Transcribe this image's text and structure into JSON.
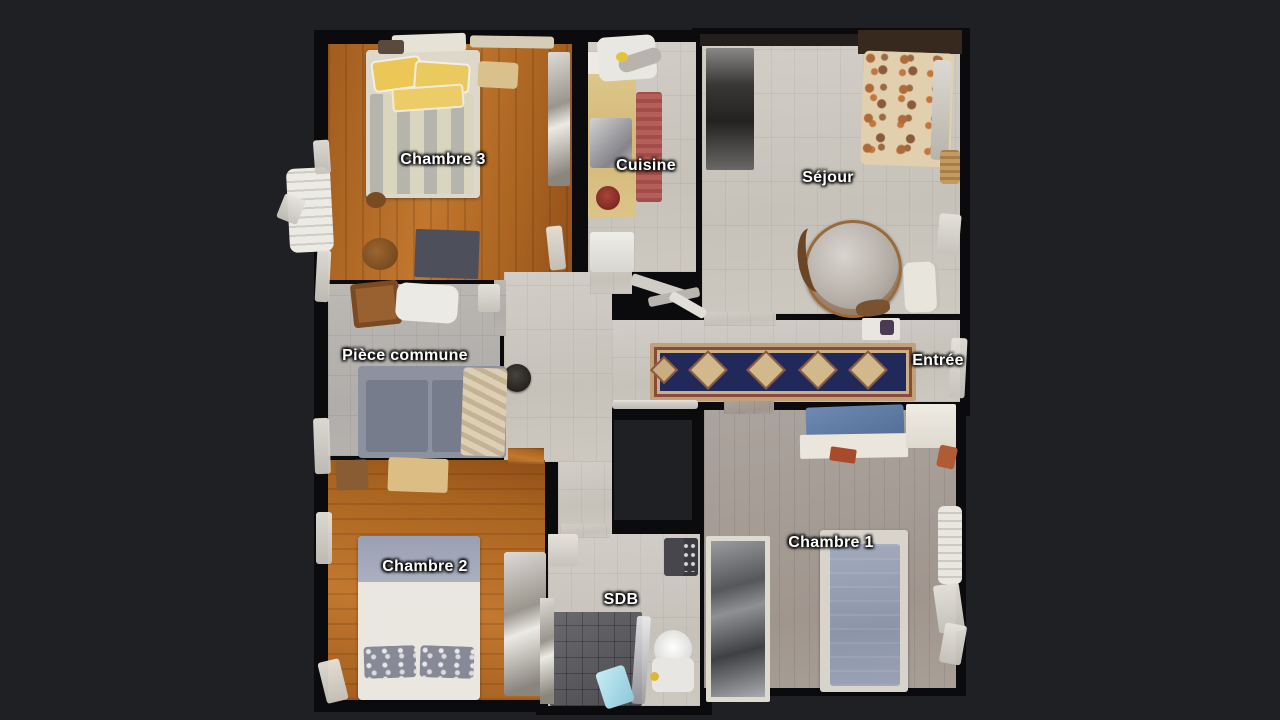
{
  "viewer": {
    "type": "3D dollhouse floor plan, top-down view",
    "background": "#1f2023"
  },
  "floorplan": {
    "rooms": [
      {
        "name": "Chambre 3",
        "floor": "hardwood"
      },
      {
        "name": "Cuisine",
        "floor": "tile"
      },
      {
        "name": "Séjour",
        "floor": "tile"
      },
      {
        "name": "Pièce commune",
        "floor": "tile"
      },
      {
        "name": "Entrée",
        "floor": "tile"
      },
      {
        "name": "Chambre 2",
        "floor": "hardwood"
      },
      {
        "name": "SDB",
        "floor": "tile"
      },
      {
        "name": "Chambre 1",
        "floor": "laminate"
      }
    ],
    "label_style": {
      "text_color": "#ffffff",
      "outline_color": "#000000"
    }
  },
  "colors": {
    "background": "#1f2023",
    "walls": "#0b0b0e",
    "hardwood": "#b06a28",
    "tile_light": "#ccc8c1",
    "tile_gray": "#b5b2ae",
    "chambre1_floor": "#a59c95",
    "hall_runner_navy": "#20295a",
    "hall_runner_border": "#c2a078",
    "kitchen_runner_red": "#b45f5a",
    "shower_gray": "#5c5c60",
    "sofa_gray": "#7e8492",
    "bed_mattress_blue": "#96a0b2"
  }
}
